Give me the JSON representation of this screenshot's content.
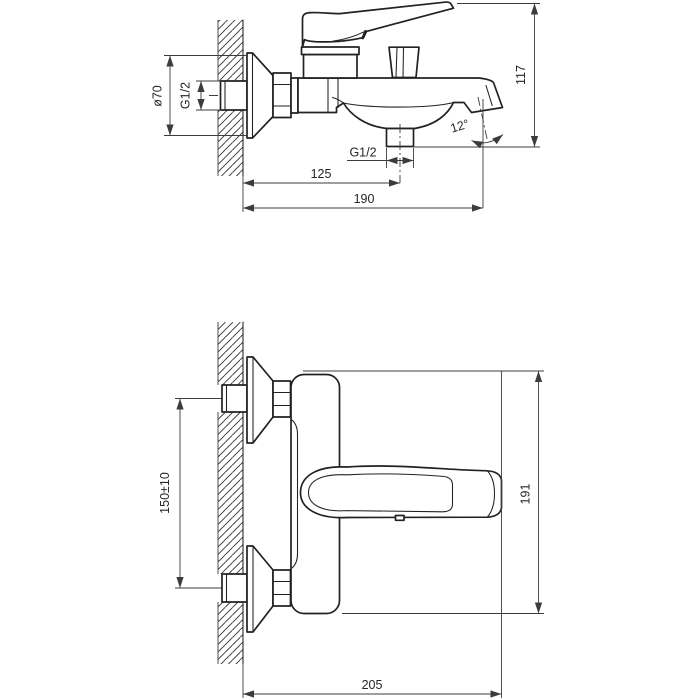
{
  "drawing": {
    "type": "technical-dimension-drawing",
    "subject": "wall-mounted-bath-mixer-faucet",
    "colors": {
      "background": "#ffffff",
      "object_line": "#222222",
      "dim_line": "#3c3c3c",
      "text": "#262626"
    },
    "dims": {
      "dia70": "ø70",
      "g12_inlet": "G1/2",
      "height117": "117",
      "angle12": "12°",
      "g12_outlet": "G1/2",
      "offset125": "125",
      "reach190": "190",
      "spacing150": "150±10",
      "height191": "191",
      "reach205": "205"
    }
  }
}
